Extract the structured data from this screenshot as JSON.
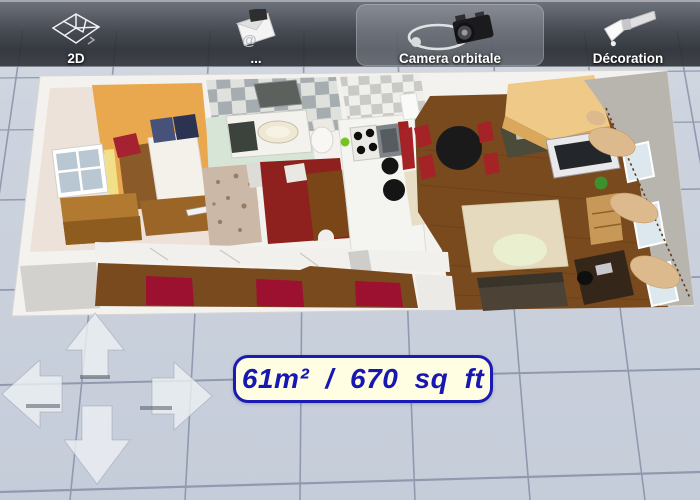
{
  "toolbar": {
    "buttons": [
      {
        "label": "2D",
        "icon": "floorplan-2d-icon",
        "selected": false
      },
      {
        "label": "...",
        "icon": "share-export-icon",
        "selected": false
      },
      {
        "label": "Camera orbitale",
        "icon": "orbital-camera-icon",
        "selected": true
      },
      {
        "label": "Décoration",
        "icon": "paintbrush-icon",
        "selected": false
      }
    ]
  },
  "viewport": {
    "area_label": {
      "text": "61m² / 670 sq ft",
      "text_color": "#1717b2",
      "background_color": "#fffee2",
      "border_color": "#1a1ab4"
    },
    "pan_control": {
      "directions": [
        "up",
        "left",
        "right",
        "down"
      ]
    }
  },
  "floor_plan": {
    "rooms": [
      "bedroom",
      "bathroom",
      "entry",
      "closet-room",
      "kitchen",
      "living-dining-room",
      "hallway"
    ],
    "colors": {
      "floor_tiles_bg": "#cad1dd",
      "grid_line": "#7e88a0",
      "outer_wall": "#f4f2ee",
      "wall_top_gray": "#b8b5af",
      "bedroom_floor": "#e9a84d",
      "bedroom_wall": "#ede2d9",
      "bathroom_floor": "#d6e5d5",
      "closet_floor": "#8e211d",
      "kitchen_cabinets": "#f4f4f0",
      "wood_floor": "#7a4a1f",
      "hallway_rug": "#9c1030",
      "living_rug": "#e5dabd",
      "sofa_tan": "#eec987",
      "curtains": "#dcba8e"
    }
  }
}
